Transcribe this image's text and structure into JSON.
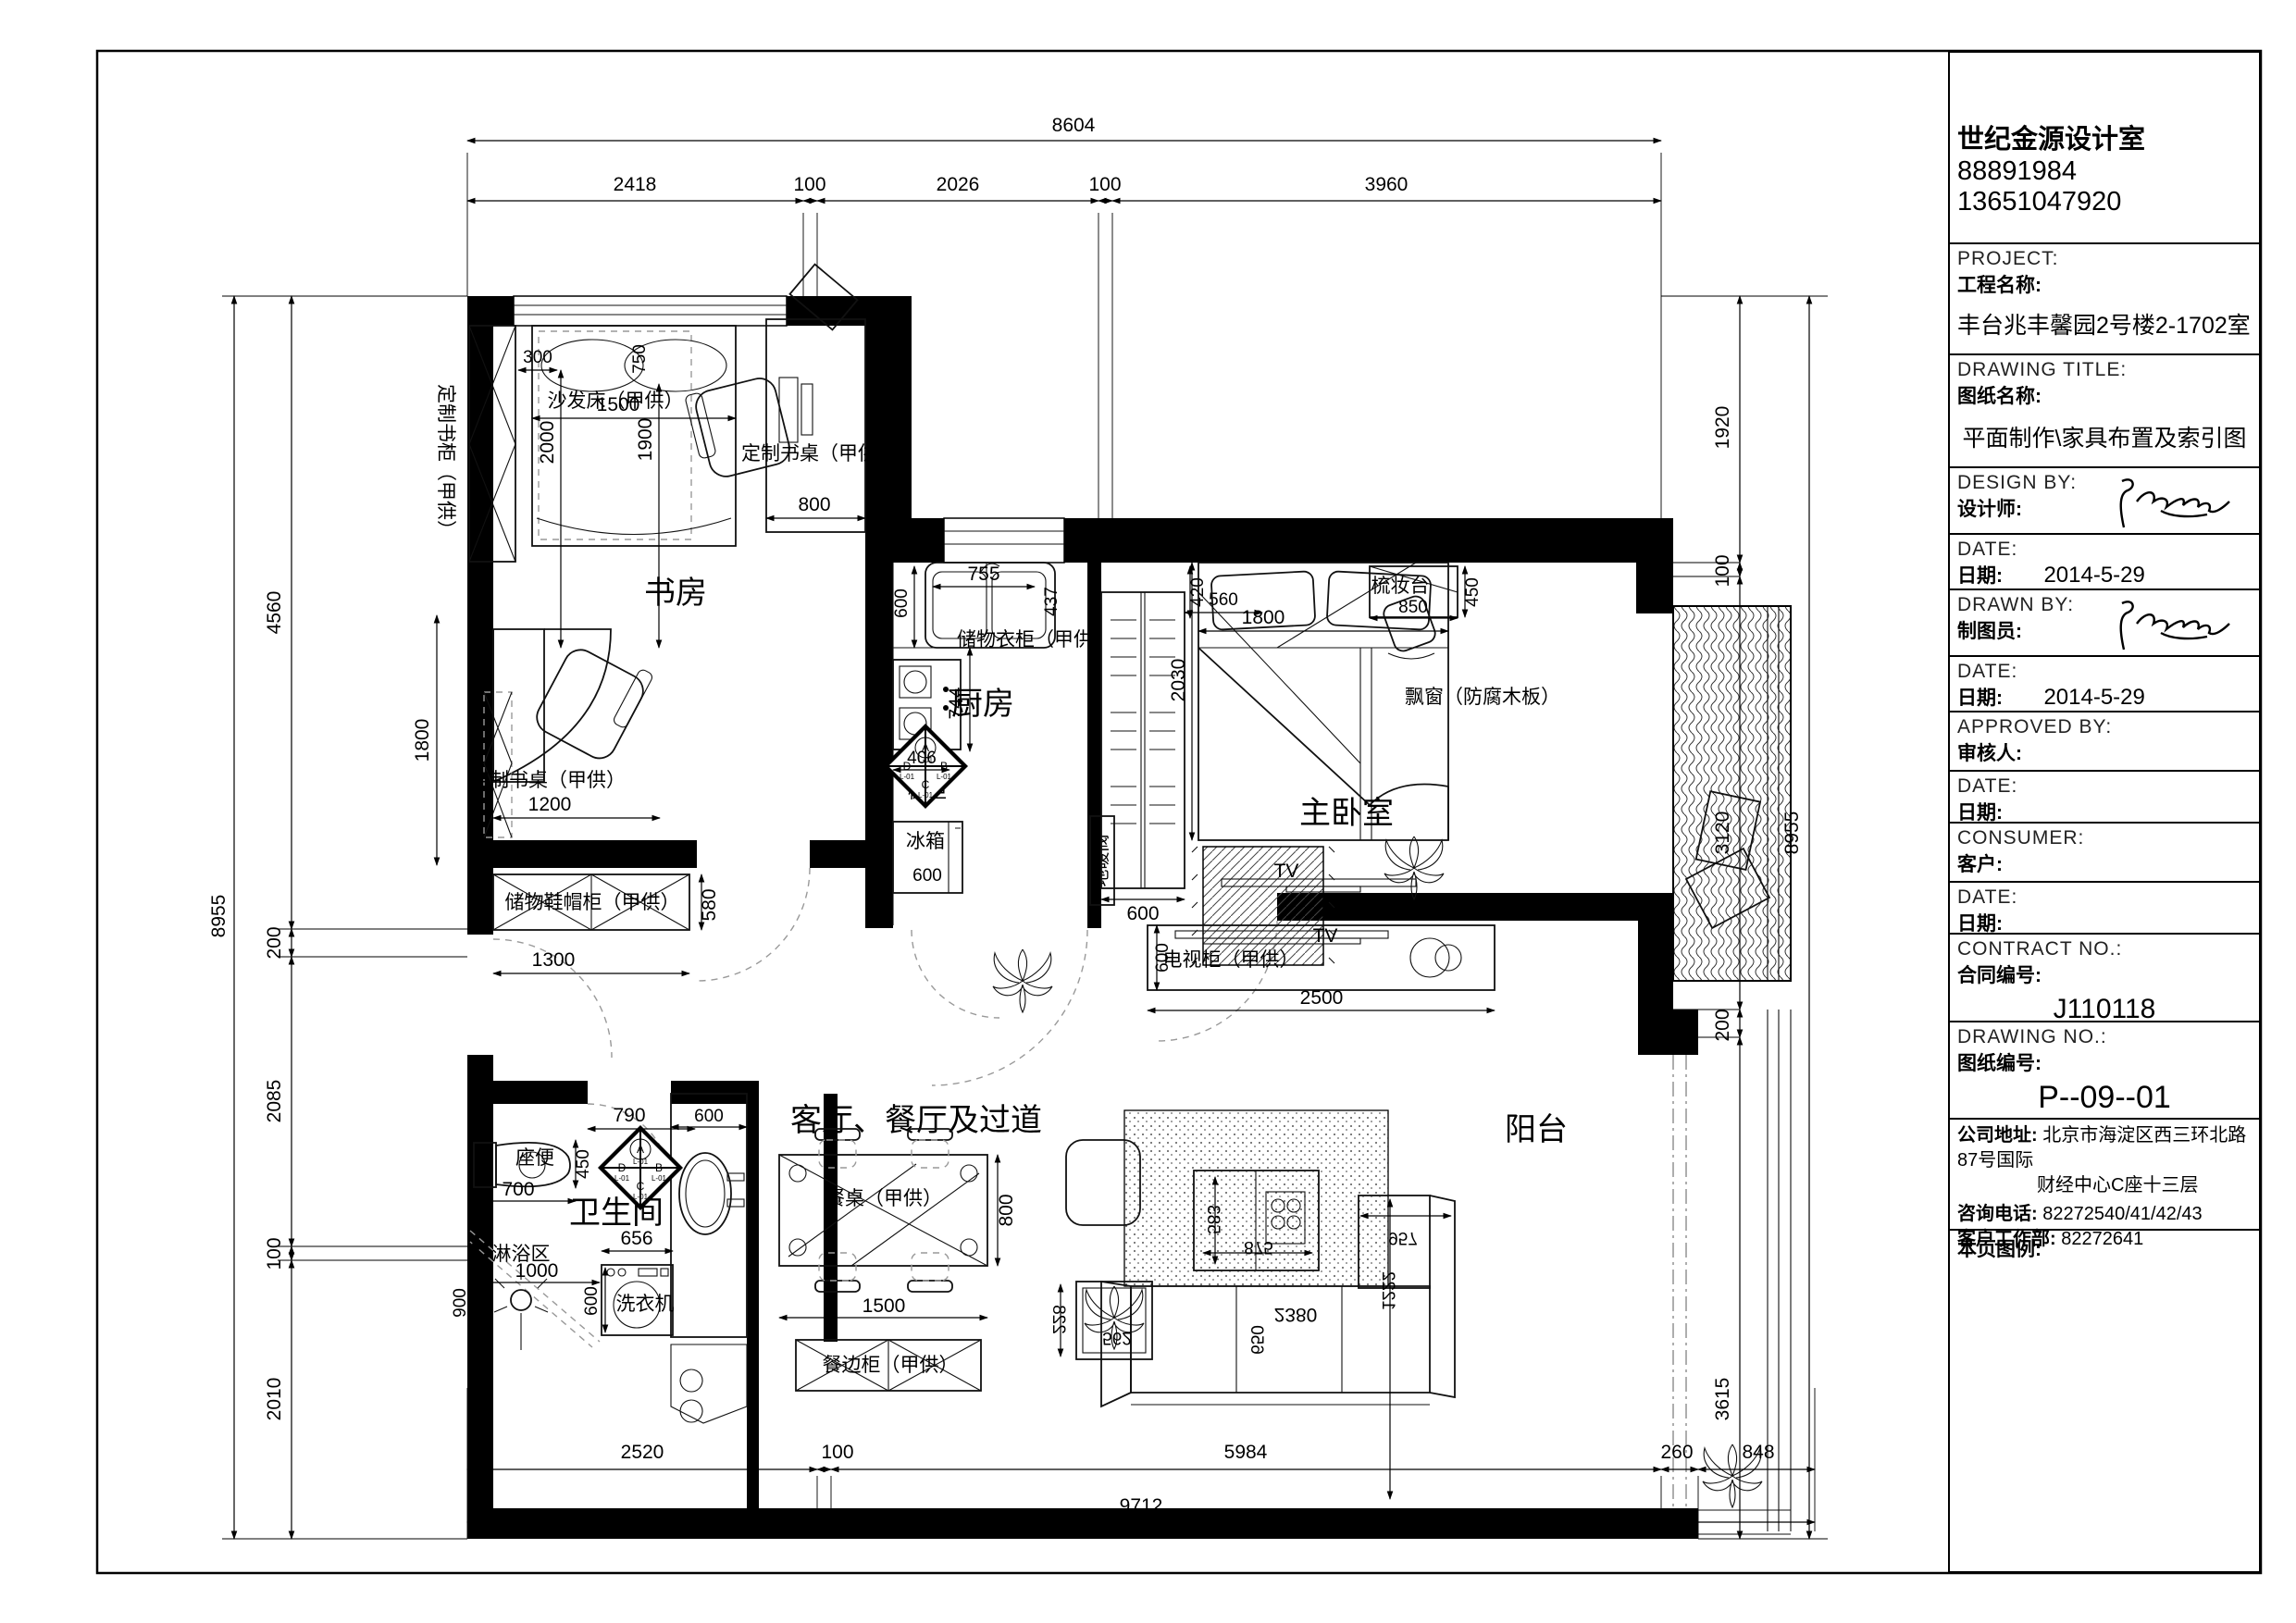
{
  "sheet": {
    "company": "世纪金源设计室",
    "phone1": "88891984",
    "phone2": "13651047920",
    "project_en": "PROJECT:",
    "project_zh": "工程名称:",
    "project_name": "丰台兆丰馨园2号楼2-1702室",
    "dtitle_en": "DRAWING TITLE:",
    "dtitle_zh": "图纸名称:",
    "drawing_title": "平面制作\\家具布置及索引图",
    "design_en": "DESIGN BY:",
    "design_zh": "设计师:",
    "date_en": "DATE:",
    "date_zh": "日期:",
    "date1": "2014-5-29",
    "drawn_en": "DRAWN BY:",
    "drawn_zh": "制图员:",
    "date2": "2014-5-29",
    "approved_en": "APPROVED BY:",
    "approved_zh": "审核人:",
    "consumer_en": "CONSUMER:",
    "consumer_zh": "客户:",
    "contract_en": "CONTRACT NO.:",
    "contract_zh": "合同编号:",
    "contract_no": "J110118",
    "dno_en": "DRAWING NO.:",
    "dno_zh": "图纸编号:",
    "drawing_no": "P--09--01",
    "addr_label": "公司地址:",
    "addr1": "北京市海淀区西三环北路87号国际",
    "addr2": "财经中心C座十三层",
    "tel_label": "咨询电话:",
    "tel": "82272540/41/42/43",
    "svc_label": "客户工作部:",
    "svc_tel": "82272641",
    "legend_label": "本页图例:"
  },
  "plan": {
    "rooms": {
      "study": "书房",
      "kitchen": "厨房",
      "bedroom": "主卧室",
      "living": "客厅、餐厅及过道",
      "bath": "卫生间",
      "balcony": "阳台"
    },
    "labels": {
      "sofa_bed": "沙发床（甲供）",
      "bookcase_left": "定制书柜（甲供）",
      "desk_top": "定制书桌（甲供）",
      "desk_left": "定制书桌（甲供）",
      "shoe_cabinet": "储物鞋帽柜（甲供）",
      "cupboard": "橱柜",
      "fridge": "冰箱",
      "wardrobe": "储物衣柜（甲供）",
      "heating_valve": "地暖阀",
      "dresser": "梳妆台",
      "bay_window": "飘窗（防腐木板）",
      "tv": "TV",
      "tv_cabinet": "电视柜（甲供）",
      "dining_table": "餐桌（甲供）",
      "sideboard": "餐边柜（甲供）",
      "toilet": "座便",
      "shower": "淋浴区",
      "washer": "洗衣机"
    },
    "elev": {
      "a": "A",
      "b": "B",
      "c": "C",
      "d": "D",
      "l": "L-01"
    },
    "dims": {
      "top_total": "8604",
      "top": [
        "2418",
        "100",
        "2026",
        "100",
        "3960"
      ],
      "bottom": [
        "2520",
        "100",
        "5984",
        "260",
        "848"
      ],
      "bottom_total": "9712",
      "left": [
        "4560",
        "200",
        "2085",
        "100",
        "2010"
      ],
      "left_total": "8955",
      "right": [
        "1920",
        "100",
        "3120",
        "200",
        "3615"
      ],
      "right_total": "8955",
      "study": {
        "a": "300",
        "b": "1500",
        "c": "2000",
        "d": "1900",
        "e": "750",
        "f": "800",
        "g": "1800",
        "h": "1200",
        "i": "580",
        "j": "1300"
      },
      "kitchen": {
        "a": "600",
        "b": "755",
        "c": "437",
        "d": "744",
        "e": "406",
        "f": "600",
        "g": "600"
      },
      "closet": {
        "a": "420",
        "b": "600",
        "c": "560"
      },
      "bedroom": {
        "a": "1800",
        "b": "2030",
        "c": "450",
        "d": "850"
      },
      "tv": {
        "a": "600",
        "b": "2500"
      },
      "bath": {
        "a": "790",
        "b": "450",
        "c": "700",
        "d": "600",
        "e": "656",
        "f": "1000",
        "g": "900",
        "h": "600"
      },
      "dining": {
        "a": "1500",
        "b": "800"
      },
      "sofa": {
        "a": "583",
        "b": "875",
        "c": "2380",
        "d": "650",
        "e": "228",
        "f": "562",
        "g": "957",
        "h": "1222"
      }
    }
  }
}
